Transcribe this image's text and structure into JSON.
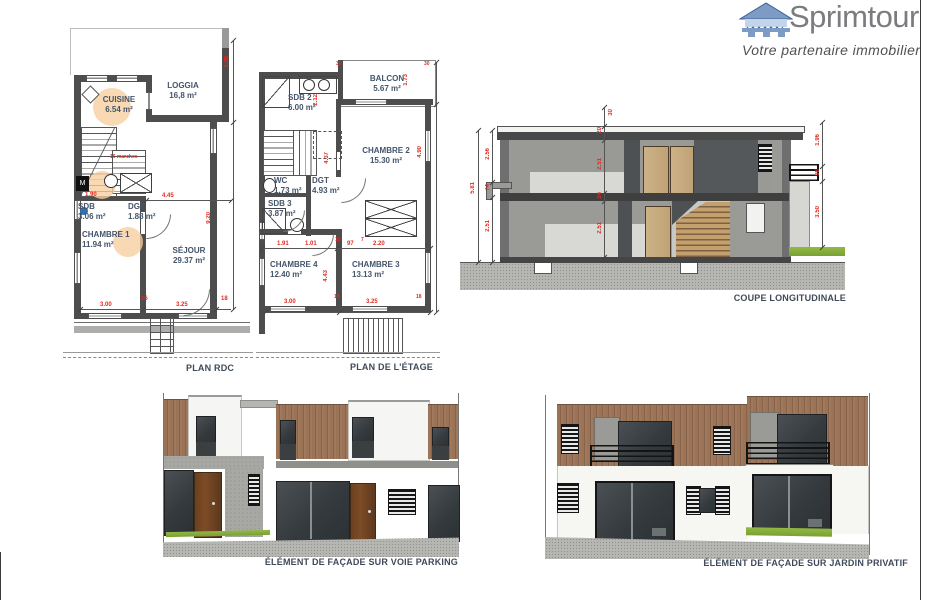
{
  "logo": {
    "name": "Sprimtour",
    "tagline": "Votre partenaire immobilier"
  },
  "plans": {
    "rdc": {
      "caption": "PLAN RDC",
      "rooms": {
        "cuisine": {
          "name": "CUISINE",
          "area": "6.54 m²"
        },
        "loggia": {
          "name": "LOGGIA",
          "area": "16,8 m²"
        },
        "sdb": {
          "name": "SDB",
          "area": "3.06 m²"
        },
        "dgt": {
          "name": "DGT",
          "area": "1.88 m²"
        },
        "chambre1": {
          "name": "CHAMBRE 1",
          "area": "11.94 m²"
        },
        "sejour": {
          "name": "SÉJOUR",
          "area": "29.37 m²"
        }
      },
      "dims": {
        "w_sdb": "1.90",
        "w_sejour_top": "4.45",
        "w_chambre": "3.00",
        "w_sejour": "3.25",
        "h_loggia": "3.98",
        "h_total": "9.20",
        "t16": "16",
        "t18": "18",
        "stair_note": "16 marches"
      }
    },
    "etage": {
      "caption": "PLAN DE L'ÉTAGE",
      "rooms": {
        "balcon": {
          "name": "BALCON",
          "area": "5.67 m²"
        },
        "sdb2": {
          "name": "SDB 2",
          "area": "6.00 m²"
        },
        "chambre2": {
          "name": "CHAMBRE 2",
          "area": "15.30 m²"
        },
        "wc": {
          "name": "WC",
          "area": "1.73 m²"
        },
        "dgt": {
          "name": "DGT",
          "area": "4.93 m²"
        },
        "sdb3": {
          "name": "SDB 3",
          "area": "3.87 m²"
        },
        "chambre4": {
          "name": "CHAMBRE 4",
          "area": "12.40 m²"
        },
        "chambre3": {
          "name": "CHAMBRE 3",
          "area": "13.13 m²"
        }
      },
      "dims": {
        "h_sdb2": "2.12",
        "h_balcon": "1.73",
        "h_dgt": "4.37",
        "h_chambre2": "4.90",
        "w_sdb3": "1.91",
        "w_door": "1.01",
        "t16": "16",
        "w_pal": "97",
        "t7": "7",
        "w_ch3top": "2.20",
        "w_chambre4": "3.00",
        "w_chambre3": "3.25",
        "h_chambre4": "4.43",
        "t18": "18",
        "t30": "30"
      }
    }
  },
  "coupe": {
    "caption": "COUPE LONGITUDINALE",
    "dims": {
      "total": "5.81",
      "upper": "2.56",
      "ledge": "74",
      "lower": "2.51",
      "acro": "30",
      "roof": "20",
      "floor_up": "2.51",
      "slab": "24",
      "floor_dn": "2.51",
      "r_top": "1.96",
      "r_rail": "98",
      "r_wall": "3.50"
    }
  },
  "facades": {
    "parking": {
      "caption": "ÉLÉMENT DE FAÇADE SUR VOIE PARKING"
    },
    "jardin": {
      "caption": "ÉLÉMENT DE FAÇADE SUR JARDIN PRIVATIF"
    }
  },
  "colors": {
    "dim_red": "#e8291d",
    "label_blue": "#44546a",
    "logo_gray": "#7b7c7f",
    "logo_blue": "#7d9cc5",
    "wood": "#96705a",
    "grass": "#85ab3f"
  }
}
